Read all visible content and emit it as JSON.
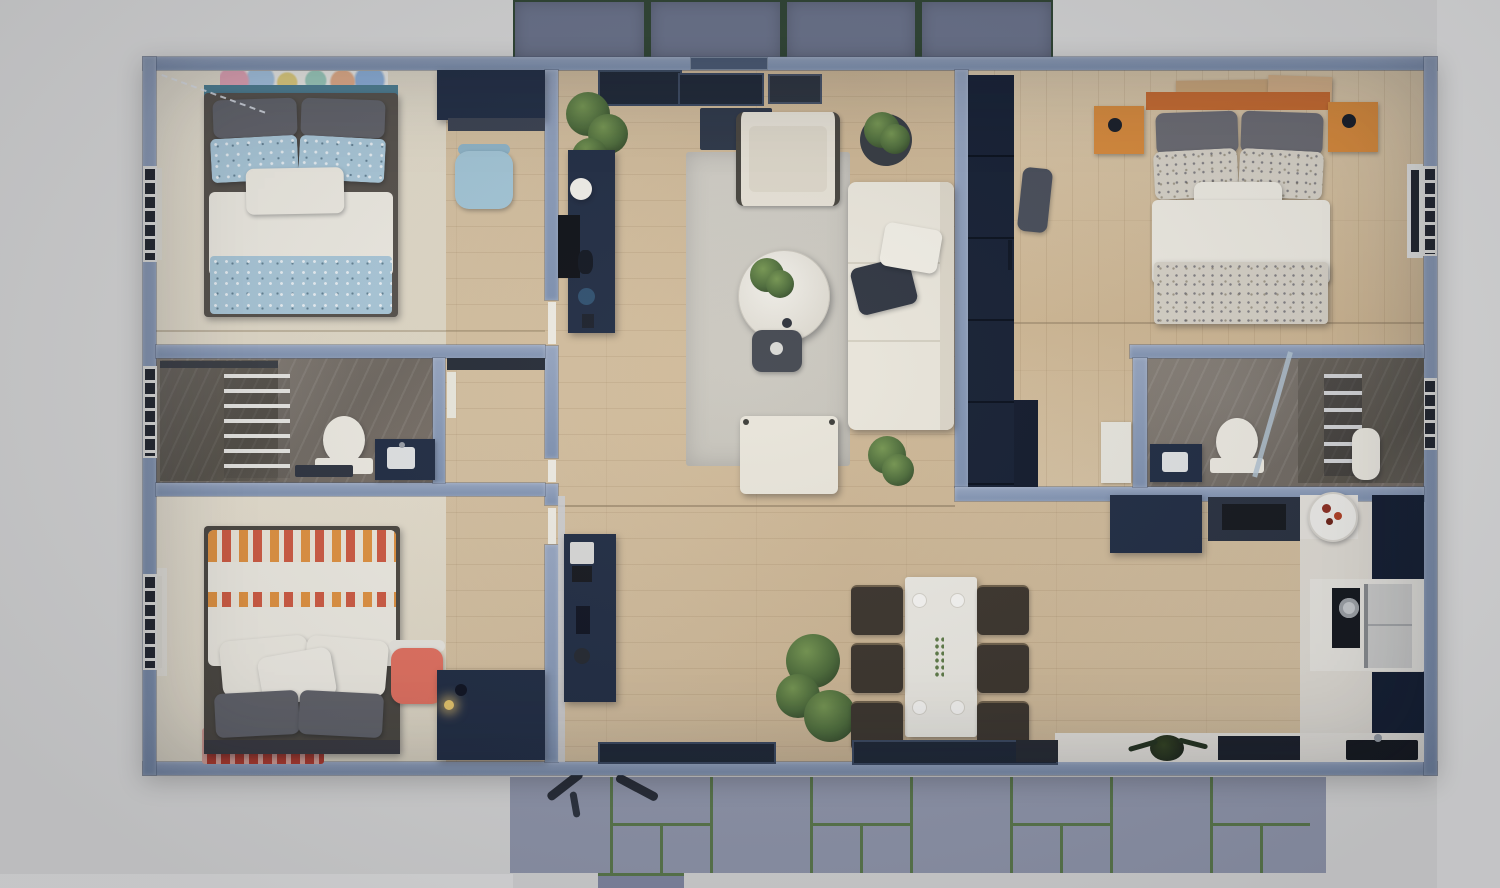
{
  "scene": {
    "type": "3d-floor-plan-top-down-render",
    "subject": "three-bedroom-container-home-floor-plan",
    "view": "top-down",
    "exterior_features": [
      "front-paver-patio",
      "back-paver-patio"
    ]
  },
  "palette": {
    "bg": "#d3d3d3",
    "bg-soft": "#dcdcdc",
    "wall": "#7e91b0",
    "wall-hi": "#97a6c1",
    "wall-deep": "#4a5a74",
    "paver-front": "#666e86",
    "joint-front": "#2c4130",
    "paver-back": "#8e94a9",
    "joint-back": "#587549",
    "wood": "#d6c2a2",
    "cream": "#eae3d3",
    "rug": "#d0cdc5",
    "marble": "#7b7369",
    "navy": "#1f2b42",
    "navy-deep": "#131d31",
    "charcoal": "#2d333f",
    "black": "#14171d",
    "white": "#efece3",
    "teal": "#4e8094",
    "blue-dot": "#abc9da",
    "sky": "#a3c6d7",
    "gray-pillow": "#616269",
    "speckle": "#d8d3c8",
    "orange": "#c96a2e",
    "orange-soft": "#d98a3a",
    "coral": "#e3705f",
    "red": "#b53a2c",
    "green": "#4b6a38",
    "glass": "#b3c4d2",
    "steel": "#c9ccd0"
  },
  "rooms": [
    {
      "id": "bedroom-blue",
      "objects": [
        "double-bed",
        "teal-headboard",
        "wall-art",
        "blue-dot-pillows",
        "desk",
        "blue-chair",
        "navy-wardrobe",
        "window-blinds"
      ]
    },
    {
      "id": "bathroom-left",
      "objects": [
        "walk-in-shower",
        "shower-slats",
        "toilet",
        "navy-vanity",
        "bath-mat",
        "window-blinds"
      ]
    },
    {
      "id": "bedroom-coral",
      "objects": [
        "double-bed",
        "patterned-duvet",
        "red-rug",
        "coral-chair",
        "navy-dresser",
        "desk-lamp",
        "window-blinds",
        "curtain"
      ]
    },
    {
      "id": "living-room",
      "objects": [
        "entry-glazing",
        "door-mat",
        "media-console",
        "tv",
        "sphere-lamp",
        "potted-plant",
        "armchair",
        "sectional-sofa",
        "throw-pillows",
        "round-coffee-table",
        "table-plant",
        "stool",
        "ottoman",
        "area-rug"
      ]
    },
    {
      "id": "dining-area",
      "objects": [
        "sideboard",
        "coffee-machine",
        "dining-table",
        "six-chairs",
        "plates",
        "floor-plant",
        "window-strips"
      ]
    },
    {
      "id": "master-bedroom",
      "objects": [
        "double-bed",
        "orange-headboard",
        "orange-nightstands",
        "wood-shelves",
        "tall-navy-wardrobe",
        "gray-armchair",
        "dresser",
        "window-blinds"
      ]
    },
    {
      "id": "bathroom-right",
      "objects": [
        "navy-vanity",
        "toilet",
        "glass-shower",
        "towel-ladder",
        "tub",
        "window-blinds"
      ]
    },
    {
      "id": "kitchen",
      "objects": [
        "navy-island",
        "dark-counter",
        "cooktop",
        "pot",
        "fridge",
        "round-rug",
        "fruit-bowl",
        "sink",
        "counter-plant",
        "tall-cabinets"
      ]
    }
  ]
}
